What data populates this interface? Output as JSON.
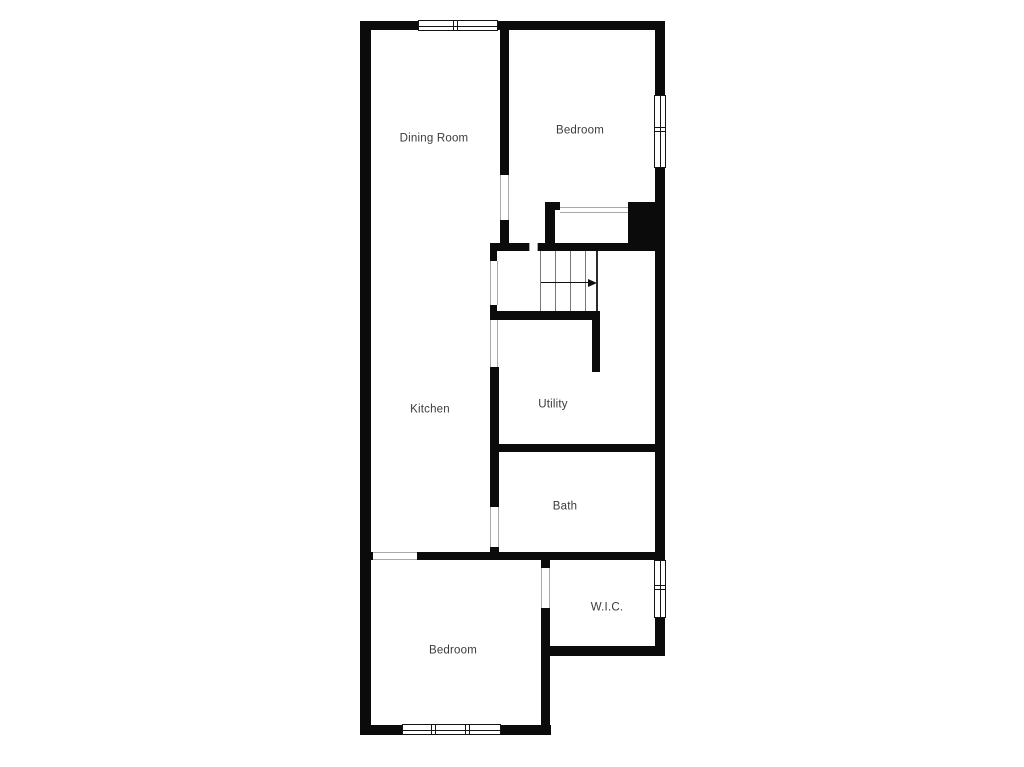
{
  "floorplan": {
    "colors": {
      "wall": "#0b0b0b",
      "background": "#ffffff",
      "label_text": "#3b3b3b",
      "stair_tread": "#787878",
      "opening_jamb": "#a9a9a9"
    },
    "rooms": [
      {
        "id": "dining-room",
        "label": "Dining Room",
        "cx": 434,
        "cy": 139
      },
      {
        "id": "bedroom-top",
        "label": "Bedroom",
        "cx": 580,
        "cy": 131
      },
      {
        "id": "kitchen",
        "label": "Kitchen",
        "cx": 430,
        "cy": 410
      },
      {
        "id": "utility",
        "label": "Utility",
        "cx": 553,
        "cy": 405
      },
      {
        "id": "bath",
        "label": "Bath",
        "cx": 565,
        "cy": 507
      },
      {
        "id": "wic",
        "label": "W.I.C.",
        "cx": 607,
        "cy": 608
      },
      {
        "id": "bedroom-bottom",
        "label": "Bedroom",
        "cx": 453,
        "cy": 651
      }
    ],
    "walls": [
      {
        "name": "outer-top-wall-left",
        "x": 360,
        "y": 21,
        "w": 58,
        "h": 9
      },
      {
        "name": "outer-top-wall-right",
        "x": 498,
        "y": 21,
        "w": 167,
        "h": 9
      },
      {
        "name": "outer-left-wall",
        "x": 360,
        "y": 21,
        "w": 11,
        "h": 714
      },
      {
        "name": "outer-right-wall-upper",
        "x": 655,
        "y": 21,
        "w": 10,
        "h": 74
      },
      {
        "name": "outer-right-wall-middle",
        "x": 655,
        "y": 168,
        "w": 10,
        "h": 392
      },
      {
        "name": "outer-right-wall-lower",
        "x": 655,
        "y": 618,
        "w": 10,
        "h": 38
      },
      {
        "name": "outer-bottom-wall-left",
        "x": 360,
        "y": 725,
        "w": 42,
        "h": 10
      },
      {
        "name": "outer-bottom-wall-right",
        "x": 501,
        "y": 725,
        "w": 50,
        "h": 10
      },
      {
        "name": "dining-bedroom-divider",
        "x": 500,
        "y": 30,
        "w": 9,
        "h": 145
      },
      {
        "name": "dining-bedroom-divider-stub",
        "x": 500,
        "y": 220,
        "w": 9,
        "h": 31
      },
      {
        "name": "bedroom-bottom-wall-stub",
        "x": 545,
        "y": 202,
        "w": 15,
        "h": 8
      },
      {
        "name": "closet-left-wall",
        "x": 545,
        "y": 210,
        "w": 10,
        "h": 41
      },
      {
        "name": "chimney-mass",
        "x": 628,
        "y": 202,
        "w": 37,
        "h": 49
      },
      {
        "name": "stairwell-top-wall-left",
        "x": 490,
        "y": 243,
        "w": 39,
        "h": 8
      },
      {
        "name": "stairwell-top-wall-right",
        "x": 538,
        "y": 243,
        "w": 127,
        "h": 8
      },
      {
        "name": "stairwell-left-nub-upper",
        "x": 490,
        "y": 243,
        "w": 7,
        "h": 18
      },
      {
        "name": "stairwell-left-nub-lower",
        "x": 490,
        "y": 305,
        "w": 7,
        "h": 15
      },
      {
        "name": "stair-bottom-wall",
        "x": 490,
        "y": 311,
        "w": 110,
        "h": 9
      },
      {
        "name": "stair-utility-divider",
        "x": 592,
        "y": 311,
        "w": 8,
        "h": 61
      },
      {
        "name": "kitchen-utility-divider",
        "x": 490,
        "y": 367,
        "w": 9,
        "h": 140
      },
      {
        "name": "kitchen-bath-stub",
        "x": 490,
        "y": 547,
        "w": 9,
        "h": 13
      },
      {
        "name": "utility-bath-divider",
        "x": 490,
        "y": 444,
        "w": 175,
        "h": 8
      },
      {
        "name": "bath-bottom-wall-left",
        "x": 360,
        "y": 552,
        "w": 13,
        "h": 8
      },
      {
        "name": "bath-bottom-wall-right",
        "x": 417,
        "y": 552,
        "w": 248,
        "h": 8
      },
      {
        "name": "bedroom-wic-divider-stub",
        "x": 541,
        "y": 560,
        "w": 9,
        "h": 8
      },
      {
        "name": "bedroom-wic-divider",
        "x": 541,
        "y": 608,
        "w": 9,
        "h": 127
      },
      {
        "name": "wic-bottom-wall",
        "x": 550,
        "y": 646,
        "w": 115,
        "h": 10
      }
    ],
    "openings": [
      {
        "name": "dining-bedroom-doorway",
        "x": 500,
        "y": 175,
        "w": 9,
        "h": 45,
        "dir": "v"
      },
      {
        "name": "closet-doorway",
        "x": 560,
        "y": 207,
        "w": 68,
        "h": 6,
        "dir": "h"
      },
      {
        "name": "stairs-top-opening",
        "x": 529,
        "y": 243,
        "w": 9,
        "h": 8,
        "dir": "v"
      },
      {
        "name": "kitchen-stairs-opening",
        "x": 490,
        "y": 261,
        "w": 8,
        "h": 44,
        "dir": "v"
      },
      {
        "name": "kitchen-utility-opening",
        "x": 490,
        "y": 320,
        "w": 8,
        "h": 47,
        "dir": "v"
      },
      {
        "name": "bath-doorway",
        "x": 490,
        "y": 507,
        "w": 9,
        "h": 40,
        "dir": "v"
      },
      {
        "name": "bedroom-doorway",
        "x": 373,
        "y": 552,
        "w": 44,
        "h": 8,
        "dir": "h"
      },
      {
        "name": "wic-doorway",
        "x": 541,
        "y": 568,
        "w": 9,
        "h": 40,
        "dir": "v"
      }
    ],
    "windows": [
      {
        "name": "window-dining-top",
        "x": 418,
        "y": 20,
        "w": 80,
        "h": 11,
        "dir": "h",
        "mullions": [
          0.46
        ]
      },
      {
        "name": "window-bedroom-right",
        "x": 654,
        "y": 95,
        "w": 12,
        "h": 73,
        "dir": "v",
        "mullions": [
          0.47
        ]
      },
      {
        "name": "window-wic-right",
        "x": 654,
        "y": 560,
        "w": 12,
        "h": 58,
        "dir": "v",
        "mullions": [
          0.46
        ]
      },
      {
        "name": "window-bedroom-bottom",
        "x": 402,
        "y": 724,
        "w": 99,
        "h": 11,
        "dir": "h",
        "mullions": [
          0.31,
          0.66
        ]
      }
    ],
    "stairs": {
      "x": 538,
      "y": 251,
      "w": 59,
      "h": 60,
      "tread_xs": [
        540,
        555,
        570,
        585
      ],
      "right_edge_x": 596,
      "arrow": {
        "y": 282,
        "x1": 541,
        "x2": 589,
        "tip_x": 597
      }
    }
  }
}
